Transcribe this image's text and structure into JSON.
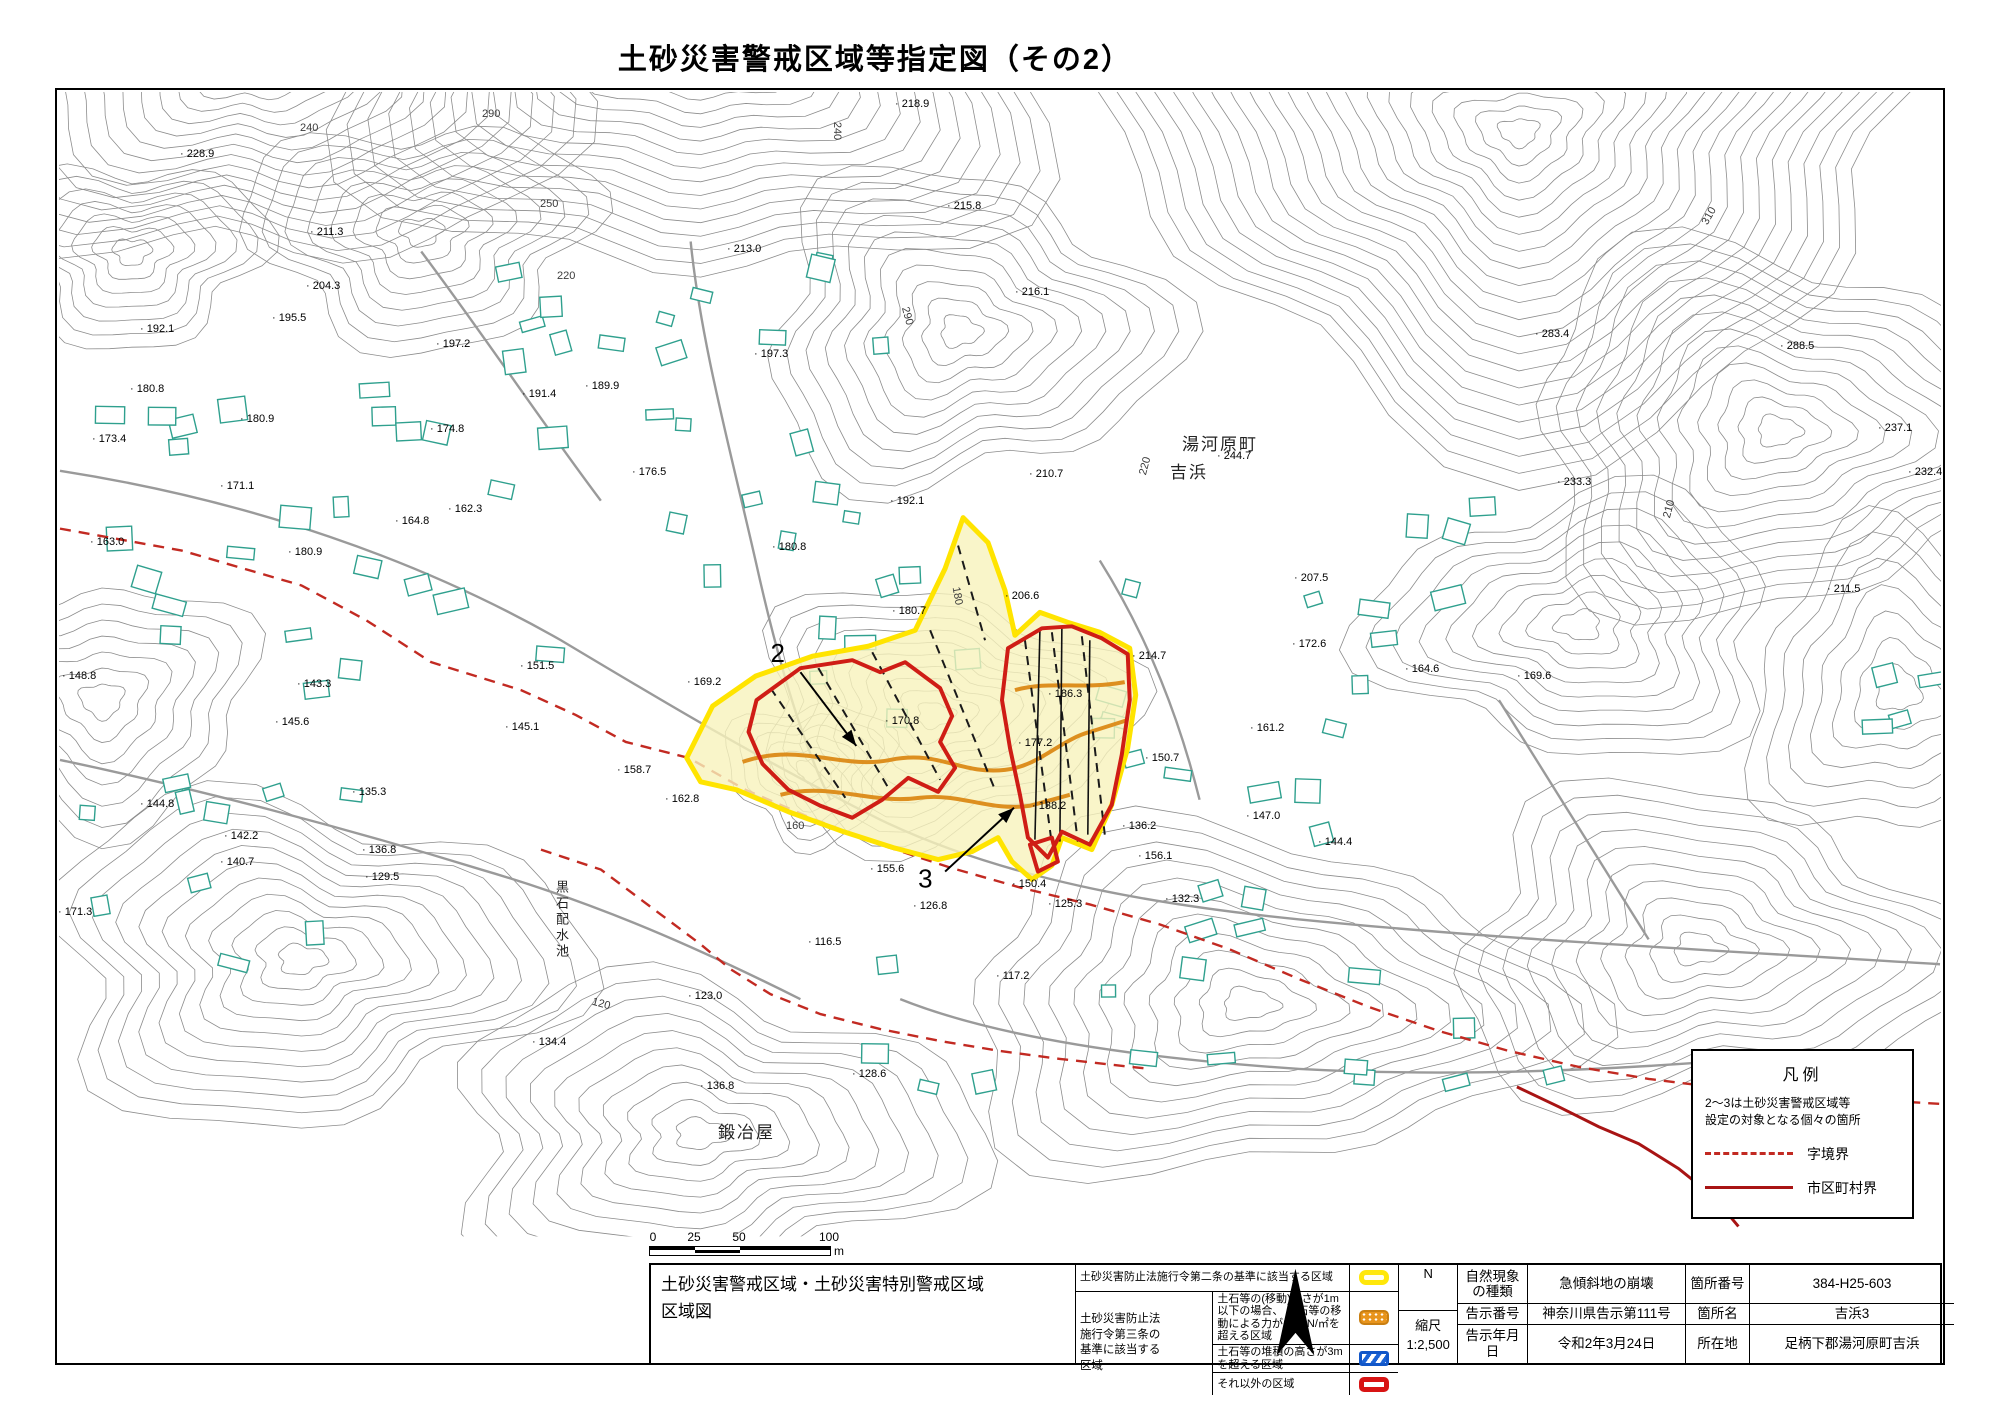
{
  "page_title": "土砂災害警戒区域等指定図（その2）",
  "map": {
    "area_labels": [
      {
        "text": "湯河原町",
        "x": 1182,
        "y": 430,
        "vertical": false
      },
      {
        "text": "吉浜",
        "x": 1170,
        "y": 458,
        "vertical": false
      },
      {
        "text": "鍛冶屋",
        "x": 718,
        "y": 1118,
        "vertical": false
      },
      {
        "text": "黒石配水池",
        "x": 552,
        "y": 880,
        "vertical": true
      }
    ],
    "spot_elevations": [
      [
        "228.9",
        180,
        148
      ],
      [
        "211.3",
        310,
        226
      ],
      [
        "204.3",
        306,
        280
      ],
      [
        "195.5",
        272,
        312
      ],
      [
        "192.1",
        140,
        323
      ],
      [
        "197.2",
        436,
        338
      ],
      [
        "180.8",
        130,
        383
      ],
      [
        "180.9",
        240,
        413
      ],
      [
        "173.4",
        92,
        433
      ],
      [
        "171.1",
        220,
        480
      ],
      [
        "163.0",
        90,
        536
      ],
      [
        "180.9",
        288,
        546
      ],
      [
        "164.8",
        395,
        515
      ],
      [
        "162.3",
        448,
        503
      ],
      [
        "151.5",
        520,
        660
      ],
      [
        "148.8",
        62,
        670
      ],
      [
        "143.3",
        297,
        678
      ],
      [
        "145.6",
        275,
        716
      ],
      [
        "145.1",
        505,
        721
      ],
      [
        "144.8",
        140,
        798
      ],
      [
        "142.2",
        224,
        830
      ],
      [
        "140.7",
        220,
        856
      ],
      [
        "135.3",
        352,
        786
      ],
      [
        "136.8",
        362,
        844
      ],
      [
        "129.5",
        365,
        871
      ],
      [
        "171.3",
        58,
        906
      ],
      [
        "189.9",
        585,
        380
      ],
      [
        "191.4",
        522,
        388
      ],
      [
        "174.8",
        430,
        423
      ],
      [
        "176.5",
        632,
        466
      ],
      [
        "158.7",
        617,
        764
      ],
      [
        "162.8",
        665,
        793
      ],
      [
        "169.2",
        687,
        676
      ],
      [
        "197.3",
        754,
        348
      ],
      [
        "213.0",
        727,
        243
      ],
      [
        "218.9",
        895,
        98
      ],
      [
        "215.8",
        947,
        200
      ],
      [
        "216.1",
        1015,
        286
      ],
      [
        "192.1",
        890,
        495
      ],
      [
        "180.8",
        772,
        541
      ],
      [
        "180.7",
        892,
        605
      ],
      [
        "170.8",
        885,
        715
      ],
      [
        "177.2",
        1018,
        737
      ],
      [
        "210.7",
        1029,
        468
      ],
      [
        "206.6",
        1005,
        590
      ],
      [
        "214.7",
        1132,
        650
      ],
      [
        "244.7",
        1217,
        450
      ],
      [
        "283.4",
        1535,
        328
      ],
      [
        "288.5",
        1780,
        340
      ],
      [
        "237.1",
        1878,
        422
      ],
      [
        "232.4",
        1908,
        466
      ],
      [
        "233.3",
        1557,
        476
      ],
      [
        "211.5",
        1827,
        583
      ],
      [
        "207.5",
        1294,
        572
      ],
      [
        "172.6",
        1292,
        638
      ],
      [
        "164.6",
        1405,
        663
      ],
      [
        "169.6",
        1517,
        670
      ],
      [
        "186.3",
        1048,
        688
      ],
      [
        "161.2",
        1250,
        722
      ],
      [
        "150.7",
        1145,
        752
      ],
      [
        "156.1",
        1138,
        850
      ],
      [
        "150.4",
        1012,
        878
      ],
      [
        "155.6",
        870,
        863
      ],
      [
        "138.2",
        1032,
        800
      ],
      [
        "136.2",
        1122,
        820
      ],
      [
        "147.0",
        1246,
        810
      ],
      [
        "144.4",
        1318,
        836
      ],
      [
        "132.3",
        1165,
        893
      ],
      [
        "126.8",
        913,
        900
      ],
      [
        "125.3",
        1048,
        898
      ],
      [
        "116.5",
        808,
        936
      ],
      [
        "117.2",
        996,
        970
      ],
      [
        "123.0",
        688,
        990
      ],
      [
        "136.8",
        700,
        1080
      ],
      [
        "128.6",
        852,
        1068
      ],
      [
        "134.4",
        532,
        1036
      ]
    ],
    "contour_labels": [
      [
        "240",
        300,
        122,
        0
      ],
      [
        "290",
        482,
        108,
        0
      ],
      [
        "250",
        540,
        198,
        0
      ],
      [
        "220",
        557,
        270,
        0
      ],
      [
        "240",
        828,
        125,
        90
      ],
      [
        "290",
        898,
        310,
        75
      ],
      [
        "310",
        1700,
        210,
        -60
      ],
      [
        "220",
        1136,
        460,
        -75
      ],
      [
        "210",
        1660,
        503,
        -75
      ],
      [
        "180",
        948,
        590,
        80
      ],
      [
        "160",
        786,
        820,
        0
      ],
      [
        "120",
        592,
        998,
        15
      ]
    ],
    "callouts": [
      {
        "label": "2",
        "lx": 770,
        "ly": 662,
        "x1": 800,
        "y1": 672,
        "x2": 856,
        "y2": 746
      },
      {
        "label": "3",
        "lx": 918,
        "ly": 888,
        "x1": 945,
        "y1": 872,
        "x2": 1014,
        "y2": 808
      }
    ],
    "legend_box": {
      "title": "凡例",
      "note": "2～3は土砂災害警戒区域等\n設定の対象となる個々の箇所",
      "items": [
        {
          "label": "字境界",
          "style": "dashed"
        },
        {
          "label": "市区町村界",
          "style": "solid"
        }
      ]
    },
    "scale_bar": {
      "labels": [
        "0",
        "25",
        "50",
        "100"
      ],
      "unit": "m"
    }
  },
  "footer": {
    "sheet_title": "土砂災害警戒区域・土砂災害特別警戒区域\n区域図",
    "legend_table": {
      "row_article2": {
        "label": "土砂災害防止法施行令第二条の基準に該当する区域",
        "swatch": "yellow"
      },
      "article3_group_label": "土砂災害防止法\n施行令第三条の\n基準に該当する\n区域",
      "rows": [
        {
          "label": "土石等の(移動)高さが1m以下の場合、\n土石等の移動による力が100kN/㎡を超える区域",
          "swatch": "orange-dots"
        },
        {
          "label": "土石等の堆積の高さが3mを超える区域",
          "swatch": "blue-hatch"
        },
        {
          "label": "それ以外の区域",
          "swatch": "red-outline"
        }
      ]
    },
    "compass_label": "N",
    "scale_label": "縮尺",
    "scale_value": "1:2,500",
    "info_table": [
      [
        "自然現象\nの種類",
        "急傾斜地の崩壊",
        "箇所番号",
        "384-H25-603"
      ],
      [
        "告示番号",
        "神奈川県告示第111号",
        "箇所名",
        "吉浜3"
      ],
      [
        "告示年月日",
        "令和2年3月24日",
        "所在地",
        "足柄下郡湯河原町吉浜"
      ]
    ]
  },
  "colors": {
    "warning_area_yellow": "#ffe400",
    "warning_area_fill": "#f8f2bb",
    "special_area_red": "#cf1d15",
    "debris_orange": "#dd8f1f",
    "aza_boundary_red": "#c22a22",
    "municipal_boundary_red": "#a81414",
    "contour_gray": "#8c8c8c",
    "building_green": "#2fa08e"
  }
}
